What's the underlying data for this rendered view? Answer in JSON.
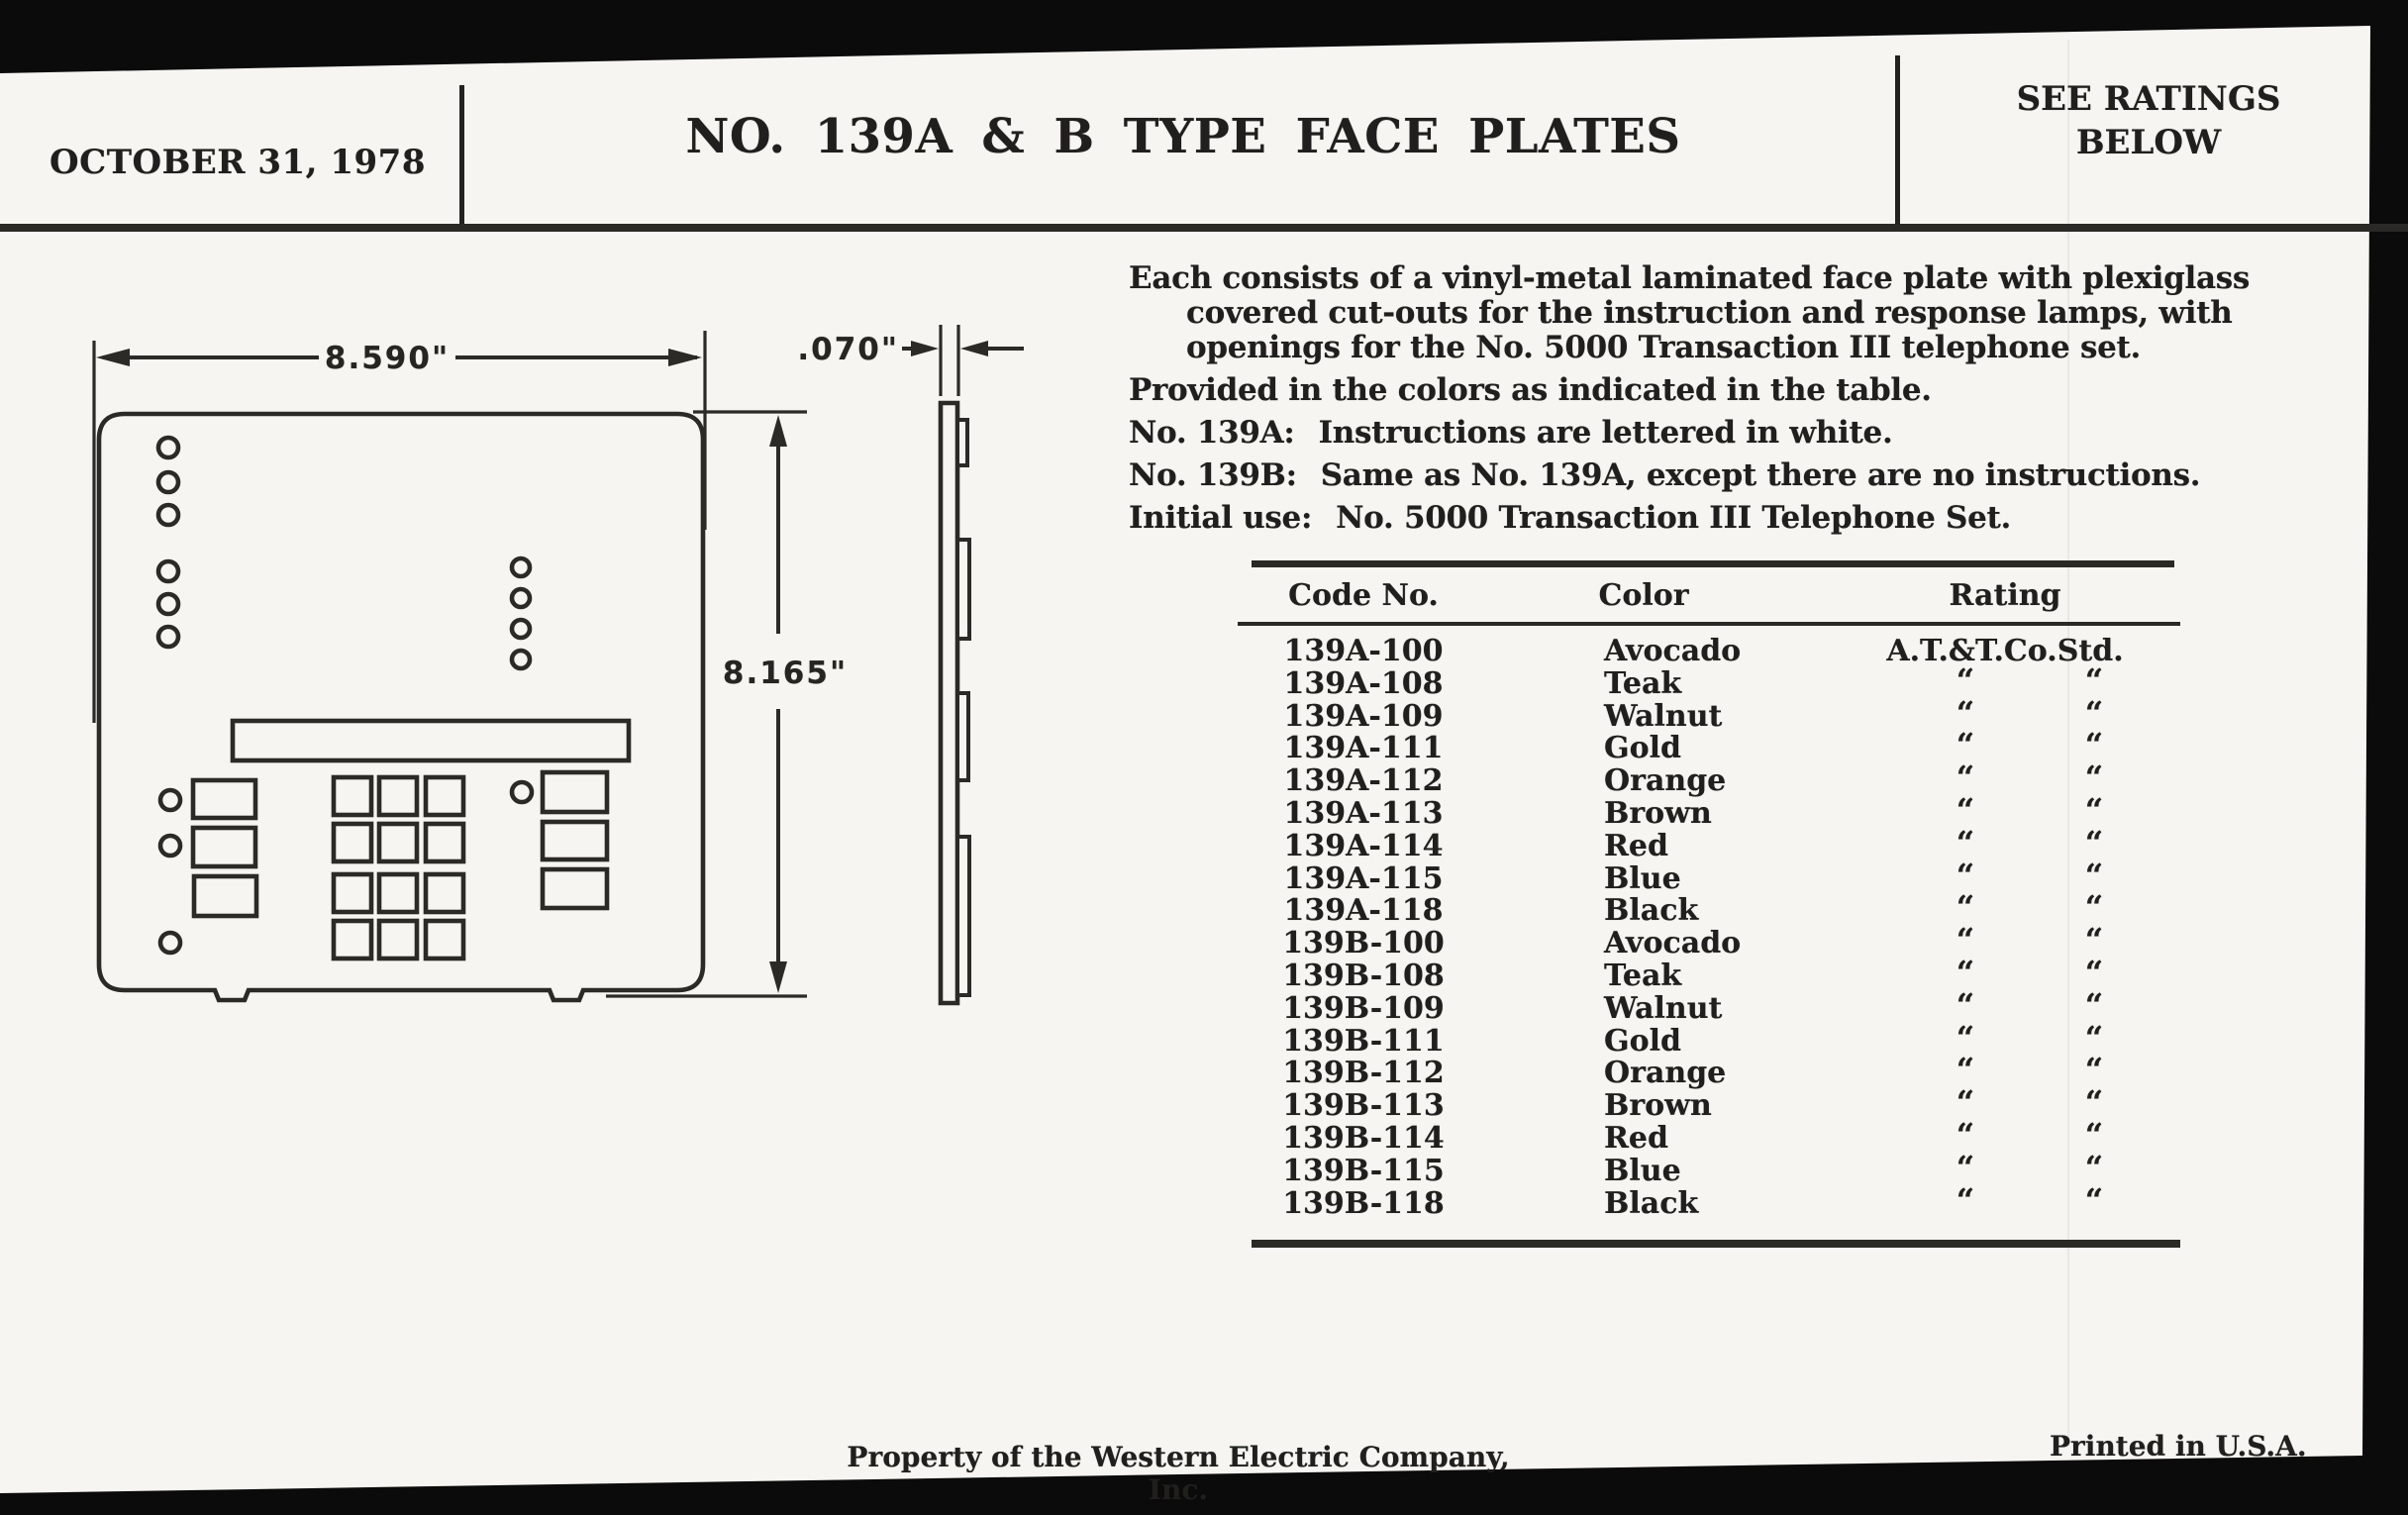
{
  "header": {
    "date": "OCTOBER 31, 1978",
    "title": "NO. 139A & B TYPE FACE PLATES",
    "ratings_note": [
      "SEE RATINGS",
      "BELOW"
    ]
  },
  "description": {
    "para1": [
      "Each consists of a vinyl-metal laminated face plate with plexiglass",
      "covered cut-outs for the instruction and response lamps, with",
      "openings for the No. 5000 Transaction III telephone set."
    ],
    "line_colors": "Provided in the colors as indicated in the table.",
    "items": [
      {
        "label": "No. 139A:",
        "text": "Instructions are lettered in white."
      },
      {
        "label": "No. 139B:",
        "text": "Same as No. 139A, except there are no instructions."
      },
      {
        "label": "Initial use:",
        "text": "No. 5000 Transaction III Telephone Set."
      }
    ]
  },
  "diagram": {
    "width_dim": "8.590\"",
    "height_dim": "8.165\"",
    "thickness_dim": ".070\""
  },
  "table": {
    "headers": [
      "Code No.",
      "Color",
      "Rating"
    ],
    "first_rating": "A.T.&T.Co.Std.",
    "ditto_mark": "“",
    "rows": [
      {
        "code": "139A-100",
        "color": "Avocado"
      },
      {
        "code": "139A-108",
        "color": "Teak"
      },
      {
        "code": "139A-109",
        "color": "Walnut"
      },
      {
        "code": "139A-111",
        "color": "Gold"
      },
      {
        "code": "139A-112",
        "color": "Orange"
      },
      {
        "code": "139A-113",
        "color": "Brown"
      },
      {
        "code": "139A-114",
        "color": "Red"
      },
      {
        "code": "139A-115",
        "color": "Blue"
      },
      {
        "code": "139A-118",
        "color": "Black"
      },
      {
        "code": "139B-100",
        "color": "Avocado"
      },
      {
        "code": "139B-108",
        "color": "Teak"
      },
      {
        "code": "139B-109",
        "color": "Walnut"
      },
      {
        "code": "139B-111",
        "color": "Gold"
      },
      {
        "code": "139B-112",
        "color": "Orange"
      },
      {
        "code": "139B-113",
        "color": "Brown"
      },
      {
        "code": "139B-114",
        "color": "Red"
      },
      {
        "code": "139B-115",
        "color": "Blue"
      },
      {
        "code": "139B-118",
        "color": "Black"
      }
    ]
  },
  "footer": {
    "left": "Property of the Western Electric Company, Inc.",
    "right": "Printed in U.S.A."
  },
  "colors": {
    "ink": "#201f1d",
    "paper": "#f6f5f1"
  }
}
